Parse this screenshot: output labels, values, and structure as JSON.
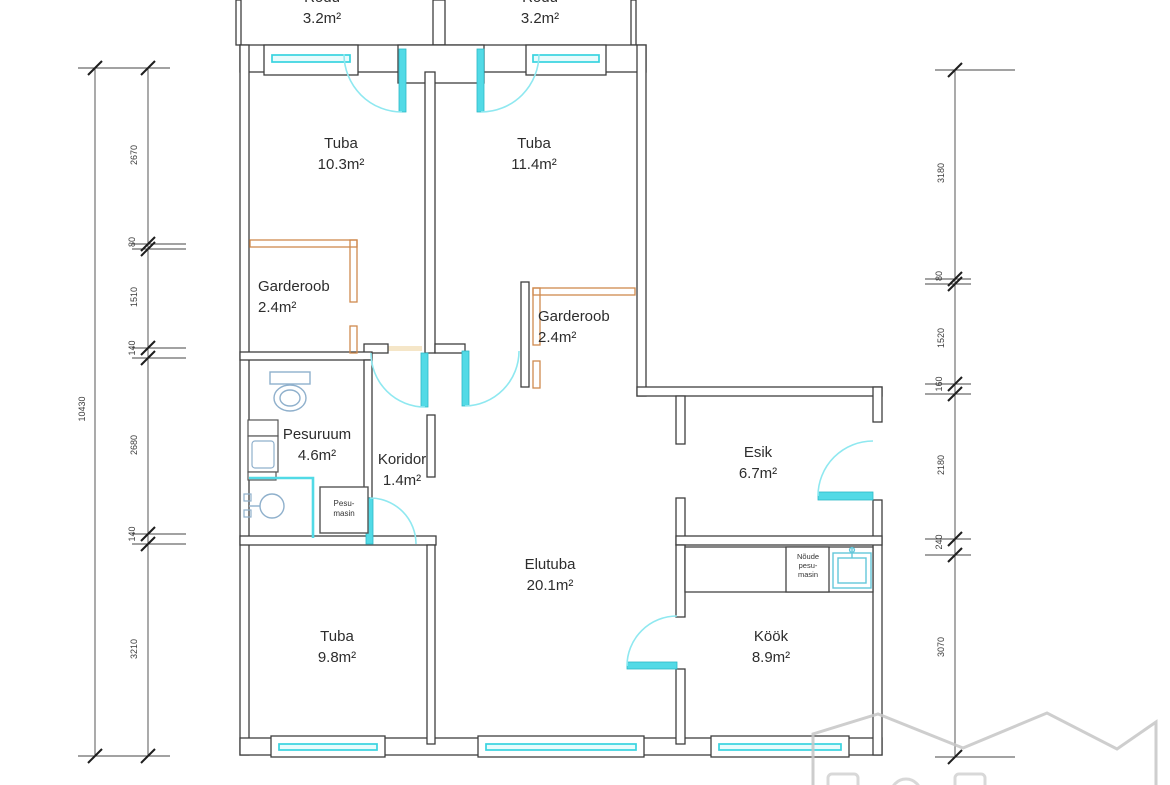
{
  "title": "apartment-floor-plan",
  "colors": {
    "wall": "#3f3f3f",
    "opening_cyan": "#52dae6",
    "closet_orange": "#cf8a4e",
    "fixture_blue": "#8fb0cc",
    "wall_finish_beige": "#f5e6c8",
    "watermark_gray": "#c5c5c5"
  },
  "rooms": [
    {
      "id": "rodu-left",
      "name": "Rõdu",
      "area": "3.2m²"
    },
    {
      "id": "rodu-right",
      "name": "Rõdu",
      "area": "3.2m²"
    },
    {
      "id": "tuba-nw",
      "name": "Tuba",
      "area": "10.3m²"
    },
    {
      "id": "tuba-ne",
      "name": "Tuba",
      "area": "11.4m²"
    },
    {
      "id": "garderoob-left",
      "name": "Garderoob",
      "area": "2.4m²"
    },
    {
      "id": "garderoob-right",
      "name": "Garderoob",
      "area": "2.4m²"
    },
    {
      "id": "pesuruum",
      "name": "Pesuruum",
      "area": "4.6m²"
    },
    {
      "id": "koridor",
      "name": "Koridor",
      "area": "1.4m²"
    },
    {
      "id": "esik",
      "name": "Esik",
      "area": "6.7m²"
    },
    {
      "id": "elutuba",
      "name": "Elutuba",
      "area": "20.1m²"
    },
    {
      "id": "tuba-sw",
      "name": "Tuba",
      "area": "9.8m²"
    },
    {
      "id": "kook",
      "name": "Köök",
      "area": "8.9m²"
    }
  ],
  "appliances": {
    "washing_machine": {
      "line1": "Pesu-",
      "line2": "masin"
    },
    "dishwasher": {
      "line1": "Nõude",
      "line2": "pesu-",
      "line3": "masin"
    }
  },
  "dimensions": {
    "left_total": "10430",
    "left_chain": [
      "2670",
      "80",
      "1510",
      "140",
      "2680",
      "140",
      "3210"
    ],
    "right_chain": [
      "3180",
      "80",
      "1520",
      "160",
      "2180",
      "240",
      "3070"
    ]
  }
}
